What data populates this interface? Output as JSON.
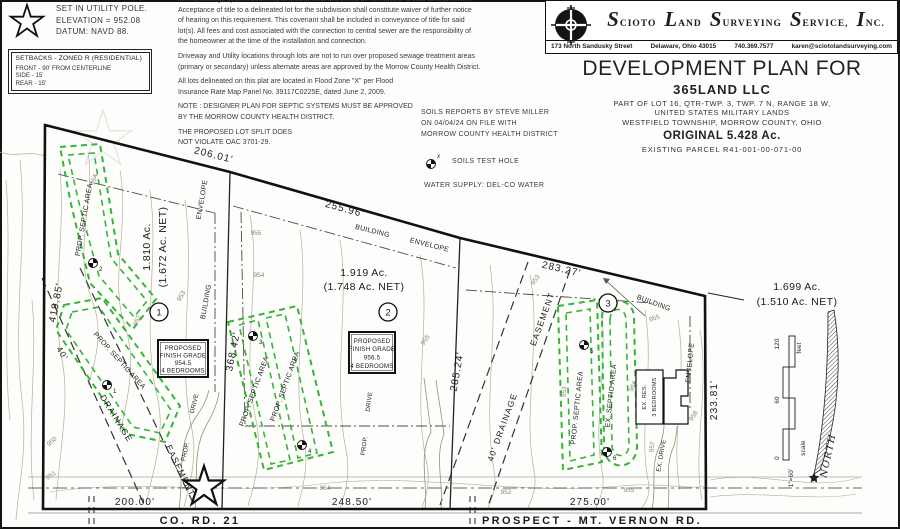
{
  "legend": {
    "benchmark_lines": [
      "SET IN UTILITY POLE.",
      "ELEVATION = 952.08",
      "DATUM: NAVD 88."
    ],
    "setbacks": {
      "title": "SETBACKS - ZONED R (RESIDENTIAL)",
      "front": "FRONT - 90' FROM CENTERLINE",
      "side": "SIDE - 15'",
      "rear": "REAR - 15'"
    },
    "soils_test_hole": "SOILS TEST HOLE",
    "test_hole_x": "x",
    "water_supply": "WATER SUPPLY: DEL-CO WATER",
    "soils_report_lines": [
      "SOILS REPORTS BY STEVE MILLER",
      "ON 04/04/24 ON FILE WITH",
      "MORROW COUNTY HEALTH DISTRICT"
    ]
  },
  "notes": {
    "clipped_line": "central sewage system becomes available, said lots are to be connected to said central sewer.",
    "p1": [
      "Acceptance of title to a delineated lot for the subdivision shall constitute waiver of further notice",
      "of hearing on this requirement.  This covenant shall be included in conveyance of title for said",
      "lot(s).  All fees and cost associated with the connection to central sewer are the responsibility of",
      "the homeowner at the time of the installation and connection."
    ],
    "p2": [
      "Driveway and Utility locations through lots are not to run over proposed sewage treatment areas",
      "(primary or secondary) unless alternate areas are approved by the Morrow County Health District."
    ],
    "p3": [
      "All lots delineated on this plat are located in Flood Zone \"X\" per Flood",
      "Insurance Rate Map Panel No. 39117C0225E, dated June 2, 2009."
    ],
    "p4": [
      "NOTE : DESIGNER PLAN FOR SEPTIC SYSTEMS MUST BE APPROVED",
      "BY THE MORROW COUNTY HEALTH DISTRICT."
    ],
    "p5": [
      "THE PROPOSED LOT SPLIT DOES",
      "NOT VIOLATE OAC 3701-29."
    ]
  },
  "firm": {
    "words": [
      "SCIOTO",
      "LAND",
      "SURVEYING",
      "SERVICE,",
      "INC."
    ],
    "address": "173 North Sandusky Street",
    "city": "Delaware, Ohio 43015",
    "phone": "740.369.7577",
    "email": "karen@sciotolandsurveying.com"
  },
  "title_block": {
    "heading": "DEVELOPMENT PLAN FOR",
    "owner": "365LAND LLC",
    "legal1": "PART OF LOT 16, QTR-TWP. 3, TWP. 7 N, RANGE 18 W,",
    "legal2": "UNITED STATES MILITARY LANDS",
    "legal3": "WESTFIELD TOWNSHIP, MORROW COUNTY, OHIO",
    "original": "ORIGINAL 5.428 Ac.",
    "parcel": "EXISTING PARCEL R41-001-00-071-00"
  },
  "plan": {
    "dims": {
      "top1": "206.01'",
      "top2": "255.96'",
      "top3": "283.27'",
      "right": "233.81'",
      "left": "419.85'",
      "lot12": "368.42'",
      "lot23": "285.24'",
      "bottom1": "200.00'",
      "bottom2": "248.50'",
      "bottom3": "275.00'"
    },
    "lots": [
      {
        "num": "1",
        "acres": "1.810 Ac.",
        "net": "(1.672 Ac. NET)",
        "grade": [
          "PROPOSED",
          "FINISH GRADE",
          "954.5",
          "4 BEDROOMS"
        ]
      },
      {
        "num": "2",
        "acres": "1.919 Ac.",
        "net": "(1.748 Ac. NET)",
        "grade": [
          "PROPOSED",
          "FINISH GRADE",
          "956.5",
          "4 BEDROOMS"
        ]
      },
      {
        "num": "3",
        "acres": "1.699 Ac.",
        "net": "(1.510 Ac. NET)"
      }
    ],
    "labels": {
      "prop_septic": "PROP. SEPTIC AREA",
      "ex_septic": "EX. SEPTIC AREA",
      "building": "BUILDING",
      "envelope": "ENVELOPE",
      "forty": "40'",
      "drainage": "DRAINAGE",
      "forty_drainage": "40' DRAINAGE",
      "easement": "EASEMENT",
      "prop": "PROP.",
      "drive": "DRIVE",
      "ex_drive": "EX. DRIVE",
      "ex_res": "EX. RES.",
      "bedrooms3": "3 BEDROOMS"
    },
    "test_holes": [
      "1",
      "2",
      "3",
      "4",
      "5",
      "6"
    ],
    "contours": {
      "c950": "950",
      "c951": "951",
      "c952": "952",
      "c953": "953",
      "c954": "954",
      "c955": "955",
      "c956": "956",
      "c957": "957",
      "c958": "958"
    },
    "roads": {
      "road1": "CO. RD. 21",
      "road2": "PROSPECT - MT. VERNON RD."
    },
    "compass": {
      "north": "NORTH"
    },
    "scalebar": {
      "zero": "0",
      "mid": "60",
      "max": "120",
      "unit": "feet",
      "scale": "scale",
      "ratio": "1\"=60'"
    }
  }
}
